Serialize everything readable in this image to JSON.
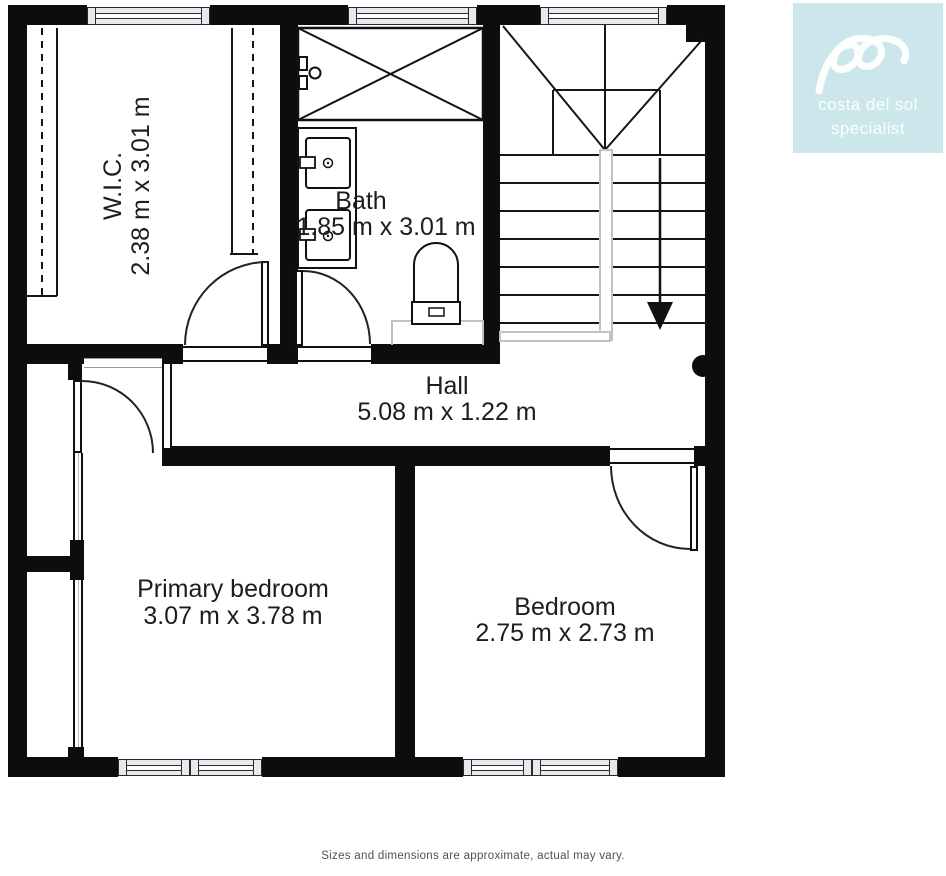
{
  "page": {
    "background": "#ffffff"
  },
  "branding": {
    "line1": "costa del sol",
    "line2": "specialist",
    "bg_color": "#cbe7ec",
    "mark": "cursive-double-loop"
  },
  "rooms": {
    "wic": {
      "name": "W.I.C.",
      "dims": "2.38 m x 3.01 m"
    },
    "bath": {
      "name": "Bath",
      "dims": "1.85 m x 3.01 m"
    },
    "hall": {
      "name": "Hall",
      "dims": "5.08 m x 1.22 m"
    },
    "primary_bedroom": {
      "name": "Primary bedroom",
      "dims": "3.07 m x 3.78 m"
    },
    "bedroom": {
      "name": "Bedroom",
      "dims": "2.75 m x 2.73 m"
    }
  },
  "fixtures": {
    "shower": "shower-tub",
    "vanity": "double-sink-vanity",
    "toilet": "toilet",
    "stairs": "staircase-with-down-arrow",
    "closet": "wardrobe-shelving"
  },
  "footer": {
    "disclaimer": "Sizes and dimensions are approximate, actual may vary."
  },
  "colors": {
    "wall": "#0d0d0d",
    "window_fill": "#e7e9f1",
    "stair_trim": "#c2c2c2",
    "label_text": "#1d1d1d",
    "disclaimer_text": "#515151"
  }
}
